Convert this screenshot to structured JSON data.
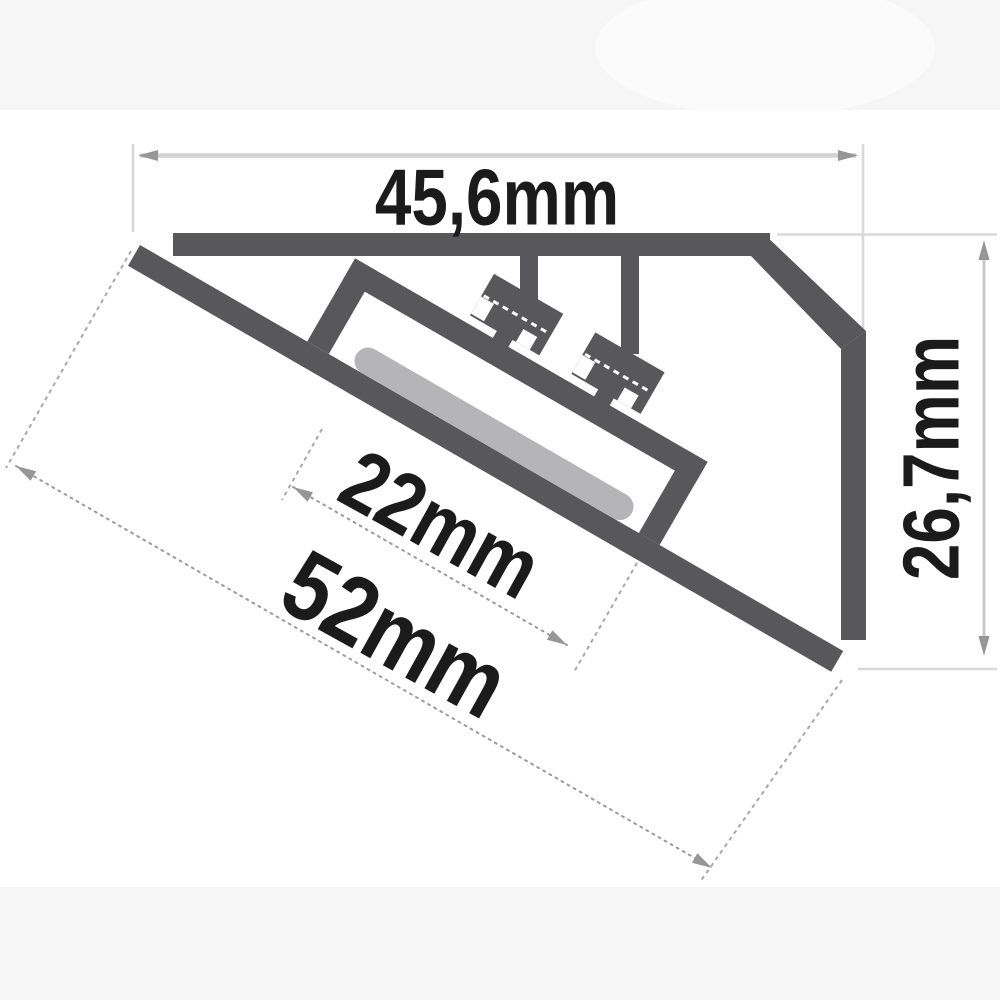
{
  "drawing": {
    "title": "Aluminium corner LED profile cross-section",
    "dimensions": {
      "top_width": "45,6mm",
      "right_height": "26,7mm",
      "inner_width": "22mm",
      "outer_width": "52mm"
    }
  },
  "colors": {
    "profile_gray": "#58575a",
    "led_strip_gray": "#b5b5b7",
    "dim_line_gray": "#9b9b9b",
    "dim_main_light": "#d2d2d2",
    "ext_line_gray": "#d8d8d8",
    "arrow_gray": "#969696",
    "text_black": "#1b1b1b",
    "band_gray": "#f6f6f7",
    "background_white": "#ffffff"
  }
}
